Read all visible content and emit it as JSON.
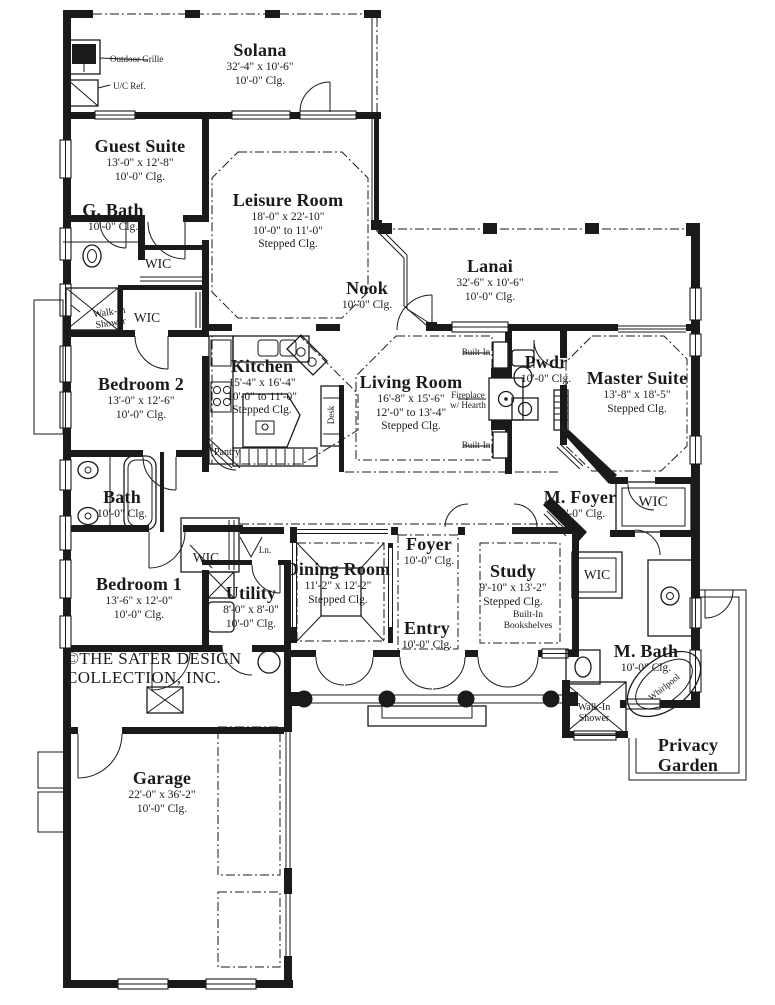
{
  "plan": {
    "brand": {
      "line1": "©THE SATER DESIGN",
      "line2": "COLLECTION, INC."
    },
    "colors": {
      "ink": "#1a1a1a",
      "paper": "#ffffff"
    },
    "rooms": {
      "solana": {
        "name": "Solana",
        "dims": "32'-4\" x 10'-6\"",
        "clg": "10'-0\" Clg."
      },
      "guest_suite": {
        "name": "Guest Suite",
        "dims": "13'-0\" x 12'-8\"",
        "clg": "10'-0\" Clg."
      },
      "g_bath": {
        "name": "G. Bath",
        "clg": "10'-0\" Clg."
      },
      "leisure_room": {
        "name": "Leisure Room",
        "dims": "18'-0\" x 22'-10\"",
        "clg": "10'-0\" to 11'-0\"",
        "clg2": "Stepped Clg."
      },
      "nook": {
        "name": "Nook",
        "clg": "10'-0\" Clg."
      },
      "lanai": {
        "name": "Lanai",
        "dims": "32'-6\" x 10'-6\"",
        "clg": "10'-0\" Clg."
      },
      "bedroom_2": {
        "name": "Bedroom 2",
        "dims": "13'-0\" x 12'-6\"",
        "clg": "10'-0\" Clg."
      },
      "kitchen": {
        "name": "Kitchen",
        "dims": "15'-4\" x 16'-4\"",
        "clg": "10'-0\" to 11'-0\"",
        "clg2": "Stepped Clg."
      },
      "living_room": {
        "name": "Living Room",
        "dims": "16'-8\" x 15'-6\"",
        "clg": "12'-0\" to 13'-4\"",
        "clg2": "Stepped Clg."
      },
      "pwdr": {
        "name": "Pwdr",
        "clg": "10'-0\" Clg."
      },
      "master_suite": {
        "name": "Master Suite",
        "dims": "13'-8\" x 18'-5\"",
        "clg": "Stepped Clg."
      },
      "bath": {
        "name": "Bath",
        "clg": "10'-0\" Clg."
      },
      "m_foyer": {
        "name": "M. Foyer",
        "clg": "10'-0\" Clg."
      },
      "bedroom_1": {
        "name": "Bedroom 1",
        "dims": "13'-6\" x 12'-0\"",
        "clg": "10'-0\" Clg."
      },
      "dining_room": {
        "name": "Dining Room",
        "dims": "11'-2\" x 12'-2\"",
        "clg": "Stepped Clg."
      },
      "foyer": {
        "name": "Foyer",
        "clg": "10'-0\" Clg."
      },
      "study": {
        "name": "Study",
        "dims": "9'-10\" x 13'-2\"",
        "clg": "Stepped Clg."
      },
      "utility": {
        "name": "Utility",
        "dims": "8'-0\" x 8'-0\"",
        "clg": "10'-0\" Clg."
      },
      "entry": {
        "name": "Entry",
        "clg": "10'-0\" Clg."
      },
      "m_bath": {
        "name": "M. Bath",
        "clg": "10'-0\" Clg."
      },
      "privacy_garden": {
        "name": "Privacy Garden"
      },
      "garage": {
        "name": "Garage",
        "dims": "22'-0\" x 36'-2\"",
        "clg": "10'-0\" Clg."
      }
    },
    "labels": {
      "outdoor_grille": "Outdoor Grille",
      "uc_ref": "U/C Ref.",
      "wic": "WIC",
      "walk_in_shower_line1": "Walk-In",
      "walk_in_shower_line2": "Shower",
      "pantry": "Pantry",
      "desk": "Desk",
      "built_in": "Built-In",
      "fireplace_line1": "Fireplace",
      "fireplace_line2": "w/ Hearth",
      "ln": "Ln.",
      "bookshelves_line1": "Built-In",
      "bookshelves_line2": "Bookshelves",
      "whirlpool": "Whirlpool"
    }
  }
}
